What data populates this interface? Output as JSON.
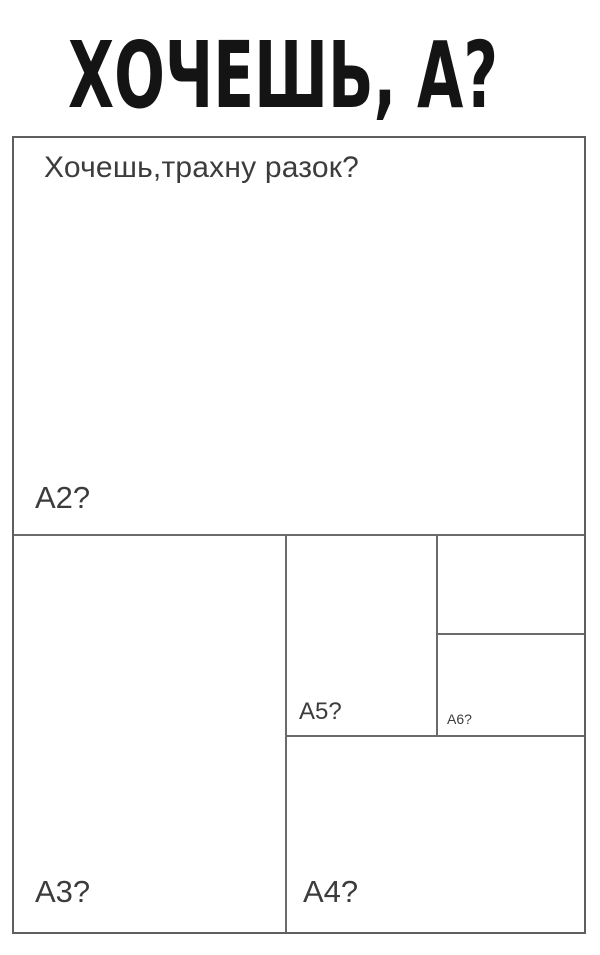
{
  "title": "ХОЧЕШЬ, А?",
  "sheet": {
    "question": "Хочешь,трахну разок?",
    "regions": {
      "a2": {
        "label": "А2?"
      },
      "a3": {
        "label": "А3?"
      },
      "a4": {
        "label": "А4?"
      },
      "a5": {
        "label": "А5?"
      },
      "a6": {
        "label": "А6?"
      },
      "a7": {
        "label": ""
      }
    }
  },
  "colors": {
    "bg": "#ffffff",
    "line": "#6a6a6a",
    "border": "#5f5f5f",
    "text": "#3c3c3c",
    "title": "#141414"
  }
}
